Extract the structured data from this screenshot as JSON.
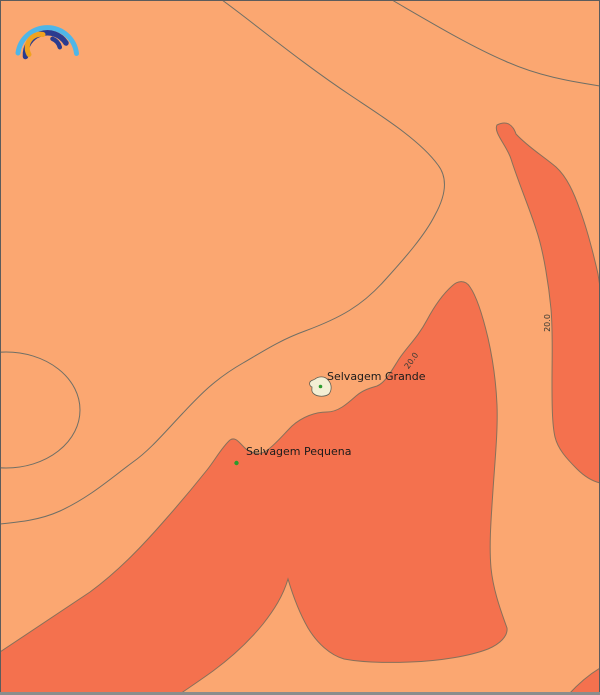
{
  "map": {
    "description": "Sea temperature contour map of the Selvagens Islands area",
    "contour_value": "20.0",
    "colors": {
      "fill_light": "#FBA771",
      "fill_warm": "#F4714E",
      "contour_line": "#6F6F66",
      "region_edge": "#87705A",
      "island_fill": "#F3EFD4",
      "marker_green": "#2C9B2C",
      "label_text": "#1B1B1B",
      "border": "#5C5C5C",
      "border_bottom": "#8C8C8C"
    },
    "places": [
      {
        "name": "Selvagem Grande",
        "marker": "island-polygon-with-green-dot",
        "x": 321,
        "y": 387
      },
      {
        "name": "Selvagem Pequena",
        "marker": "green-dot",
        "x": 236,
        "y": 463
      }
    ],
    "contour_labels": [
      {
        "value": "20.0",
        "x": 413,
        "y": 361,
        "rotation_deg": -55
      },
      {
        "value": "20.0",
        "x": 547,
        "y": 323,
        "rotation_deg": -90
      }
    ],
    "logo": {
      "name": "meteoblue-rainbow-logo",
      "arc_colors": [
        "#4FB6E8",
        "#2B3B8F",
        "#F1A21F"
      ]
    }
  }
}
